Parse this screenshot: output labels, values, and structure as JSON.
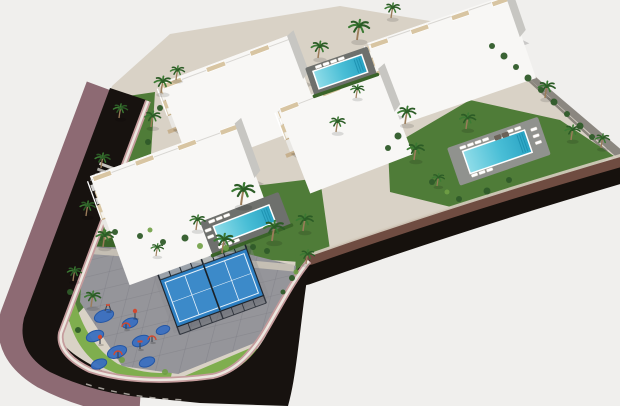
{
  "meta": {
    "type": "3d-aerial-architectural-render",
    "subject": "residential apartment complex with swimming pools, padel court, playground and curving road",
    "width": 620,
    "height": 406
  },
  "palette": {
    "bg": "#f0efed",
    "terrain": "#d9d2c6",
    "stone": "#8b8780",
    "stoneShadow": "#49453f",
    "brown": "#6f4c41",
    "black": "#16110d",
    "asphalt": "#17120f",
    "sidewalk": "#8d6a73",
    "curbPink": "#c59c9d",
    "curbLight": "#ece7df",
    "tanCurb": "#d6cec0",
    "lawn": "#4f7c38",
    "lawnDark": "#3a6429",
    "lawnBright": "#7fae4e",
    "plaza": "#95959a",
    "plazaLine": "#7e7e86",
    "walkway": "#cac3b7",
    "poolShallow": "#8edce8",
    "poolDeep": "#2ba4c4",
    "poolStep": "#1f93b2",
    "deckDark": "#6e706d",
    "deckLight": "#90928e",
    "lounger": "#ffffff",
    "loungerEdge": "#cfc8bb",
    "daybed": "#6b6258",
    "court": "#2d7fc2",
    "courtLight": "#5aa0d8",
    "courtLine": "#e8f2fa",
    "fence": "#20262e",
    "mat": "#3a6fc0",
    "matEdge": "#2456a4",
    "equipRed": "#d2492f",
    "equipPost": "#424750",
    "facade": "#f2f1ef",
    "roof": "#f8f7f5",
    "beige": "#d8c5a2",
    "beigeDark": "#c3ab83",
    "opening": "#454c55",
    "side": "#c7c6c2",
    "ground": "#e9e7e3",
    "railing": "#ffffff",
    "palm": "#3b7a33",
    "palmDark": "#2c5c26",
    "trunk": "#9b7c5a",
    "bush": "#2f5b29",
    "bushLight": "#6f9f45"
  },
  "scene": {
    "terrain": "M112,86 L170,34 L340,6 L484,30 L622,154 L622,158 L500,198 L380,234 L312,258 L298,302 L288,402 L160,398 L70,360 L26,316 Z",
    "stone_wall": {
      "poly": "M478,28 L624,152 L624,164 L486,40 Z",
      "shadow": "M483,38 L622,166"
    },
    "bands": {
      "tan_curb": "M312,254 Q452,205 622,155",
      "brown": "M310,260 Q452,210 624,161",
      "black": "M306,275 Q455,222 626,172"
    },
    "road": {
      "sidewalk": "M99,86 L13,316 Q4,352 44,376 Q90,400 140,403",
      "asphalt": "M110,88 L24,318 Q16,352 50,372 Q95,394 150,398 L200,403 L288,406 C298,370 300,320 310,260 C300,272 286,296 269,330 C256,356 238,372 215,378 Q165,388 105,372 Q64,352 59,337 L146,100 Z",
      "curb": "M148,101 L61,333 Q57,354 90,370 Q138,386 213,376 C236,371 253,352 267,328 C282,302 296,276 309,261",
      "lane_dashes": "M86,384 Q130,398 185,400",
      "crosswalk": {
        "x": 100,
        "y": 162,
        "angle": 20.5,
        "bars": 4
      }
    },
    "lawns": [
      {
        "d": "M114,98 L155,92 L150,170 L100,290 L70,322 L62,316 L90,220 L105,150 Z",
        "c": "lawn"
      },
      {
        "d": "M180,195 L320,178 L330,250 L300,262 L240,258 L185,240 Z",
        "c": "lawn"
      },
      {
        "d": "M388,148 L470,100 L560,120 L614,156 L560,182 L455,208 L390,192 Z",
        "c": "lawn"
      },
      {
        "d": "M88,234 L252,246 L250,258 L86,250 Z",
        "c": "lawnDark"
      },
      {
        "d": "M74,298 Q86,344 118,364 Q148,376 172,372 L170,382 Q134,384 100,366 Q72,346 66,306 Z",
        "c": "lawnBright"
      },
      {
        "d": "M180,378 L255,346 L262,356 L190,388 Z",
        "c": "lawnBright"
      },
      {
        "d": "M296,254 L312,250 L306,286 L294,290 Z",
        "c": "lawn"
      }
    ],
    "plaza": {
      "outline": "M84,246 L240,252 L296,266 L288,322 L252,344 L178,374 L122,366 L80,302 Z",
      "walkway": "M84,250 Q190,258 294,268"
    },
    "court": {
      "x": 160,
      "y": 280,
      "angle": -20,
      "w": 92,
      "h": 50
    },
    "playground": {
      "mats": [
        [
          104,
          316,
          10
        ],
        [
          130,
          323,
          8
        ],
        [
          95,
          336,
          9
        ],
        [
          141,
          341,
          9
        ],
        [
          117,
          352,
          10
        ],
        [
          99,
          364,
          8
        ],
        [
          147,
          362,
          8
        ],
        [
          163,
          330,
          7
        ]
      ],
      "equipment": [
        [
          108,
          311,
          3
        ],
        [
          126,
          329,
          1
        ],
        [
          100,
          344,
          0
        ],
        [
          140,
          349,
          2
        ],
        [
          118,
          357,
          1
        ],
        [
          135,
          318,
          0
        ],
        [
          152,
          342,
          1
        ]
      ]
    },
    "pools": [
      {
        "name": "rooftop-pool-north",
        "x": 305,
        "y": 68,
        "a": -19,
        "dw": 66,
        "dh": 30,
        "pw": 50,
        "ph": 17,
        "deck": "deckDark",
        "hedge": true,
        "lo": [
          [
            10,
            1.5
          ],
          [
            18,
            1.5
          ],
          [
            26,
            1.5
          ],
          [
            34,
            1.5
          ]
        ],
        "db": []
      },
      {
        "name": "pool-east",
        "x": 447,
        "y": 148,
        "a": -19,
        "dw": 96,
        "dh": 40,
        "pw": 64,
        "ph": 22,
        "deck": "deckLight",
        "hedge": false,
        "lo": [
          [
            12,
            3
          ],
          [
            20,
            3
          ],
          [
            28,
            3
          ],
          [
            36,
            3
          ],
          [
            62,
            3
          ],
          [
            70,
            3
          ],
          [
            14,
            33
          ],
          [
            22,
            33
          ],
          [
            30,
            33
          ],
          [
            85,
            9
          ],
          [
            85,
            16
          ],
          [
            85,
            23
          ]
        ],
        "db": [
          [
            48,
            4
          ],
          [
            56,
            4
          ]
        ]
      },
      {
        "name": "pool-central",
        "x": 200,
        "y": 222,
        "a": -21,
        "dw": 84,
        "dh": 36,
        "pw": 58,
        "ph": 17,
        "deck": "deckDark",
        "hedge": true,
        "lo": [
          [
            8,
            2
          ],
          [
            16,
            2
          ],
          [
            24,
            2
          ],
          [
            8,
            29
          ],
          [
            16,
            29
          ],
          [
            24,
            29
          ],
          [
            1.5,
            9
          ],
          [
            1.5,
            16
          ]
        ],
        "db": []
      }
    ],
    "buildings": [
      {
        "name": "block-a",
        "x": 172,
        "y": 128,
        "a": -20.5,
        "len": 140,
        "d": 46,
        "bays": 6
      },
      {
        "name": "block-b",
        "x": 378,
        "y": 86,
        "a": -19,
        "len": 150,
        "d": 44,
        "bays": 7
      },
      {
        "name": "block-c",
        "x": 290,
        "y": 152,
        "a": -21,
        "len": 112,
        "d": 46,
        "bays": 5
      },
      {
        "name": "block-d",
        "x": 106,
        "y": 232,
        "a": -20,
        "len": 158,
        "d": 58,
        "bays": 7
      }
    ],
    "retaining_walls": [
      "M168,132 L305,83",
      "M286,156 L392,114",
      "M104,238 L250,184"
    ],
    "palms": [
      [
        357,
        40,
        1.15
      ],
      [
        391,
        18,
        0.85
      ],
      [
        318,
        58,
        0.95
      ],
      [
        161,
        93,
        0.95
      ],
      [
        176,
        80,
        0.8
      ],
      [
        151,
        127,
        0.9
      ],
      [
        119,
        118,
        0.8
      ],
      [
        101,
        168,
        0.85
      ],
      [
        86,
        216,
        0.85
      ],
      [
        103,
        247,
        0.95
      ],
      [
        73,
        281,
        0.8
      ],
      [
        91,
        307,
        0.9
      ],
      [
        241,
        205,
        1.25
      ],
      [
        272,
        241,
        1.15
      ],
      [
        222,
        253,
        1.1
      ],
      [
        303,
        231,
        0.95
      ],
      [
        196,
        230,
        0.85
      ],
      [
        306,
        264,
        0.8
      ],
      [
        405,
        124,
        1.0
      ],
      [
        414,
        160,
        0.95
      ],
      [
        466,
        129,
        0.9
      ],
      [
        545,
        98,
        0.95
      ],
      [
        571,
        140,
        0.85
      ],
      [
        601,
        148,
        0.8
      ],
      [
        336,
        132,
        0.85
      ],
      [
        356,
        98,
        0.75
      ],
      [
        437,
        186,
        0.7
      ],
      [
        156,
        256,
        0.7
      ]
    ],
    "bushes": [
      [
        492,
        46,
        3
      ],
      [
        504,
        56,
        3.5
      ],
      [
        516,
        67,
        3
      ],
      [
        528,
        78,
        3.5
      ],
      [
        541,
        90,
        3
      ],
      [
        554,
        102,
        3.5
      ],
      [
        567,
        114,
        3
      ],
      [
        580,
        126,
        3.5
      ],
      [
        592,
        137,
        3
      ],
      [
        253,
        247,
        3
      ],
      [
        267,
        251,
        3
      ],
      [
        185,
        238,
        3.5
      ],
      [
        163,
        242,
        3
      ],
      [
        140,
        236,
        3
      ],
      [
        115,
        232,
        3
      ],
      [
        432,
        182,
        3
      ],
      [
        459,
        199,
        3
      ],
      [
        487,
        191,
        3.5
      ],
      [
        509,
        180,
        3
      ],
      [
        398,
        136,
        3.5
      ],
      [
        388,
        148,
        3
      ],
      [
        160,
        108,
        3
      ],
      [
        148,
        142,
        3
      ],
      [
        70,
        292,
        3
      ],
      [
        78,
        330,
        3
      ],
      [
        292,
        278,
        3
      ],
      [
        283,
        292,
        2.5
      ]
    ],
    "bushes_light": [
      [
        200,
        246,
        3
      ],
      [
        226,
        248,
        3
      ],
      [
        296,
        272,
        2.5
      ],
      [
        150,
        230,
        2.5
      ],
      [
        122,
        360,
        3
      ],
      [
        165,
        372,
        3
      ],
      [
        447,
        192,
        2.5
      ]
    ]
  }
}
